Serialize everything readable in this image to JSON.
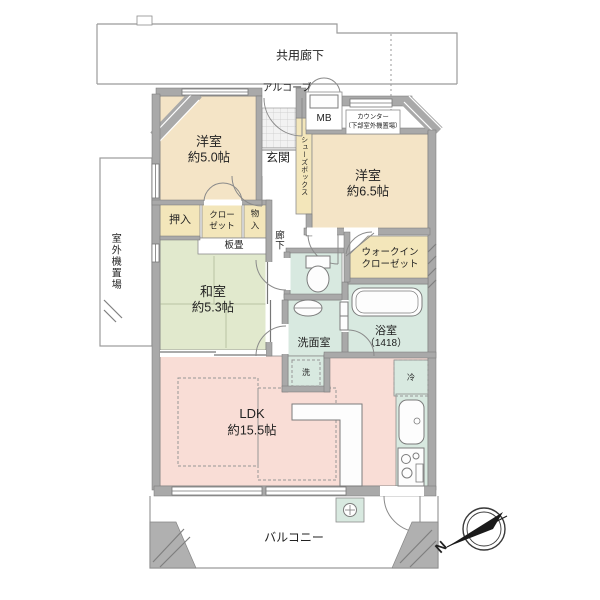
{
  "colors": {
    "wall": "#a9a9a9",
    "beige": "#f4e4c6",
    "cream": "#f3e6ba",
    "green": "#e1e9cd",
    "pink": "#f9ddd6",
    "teal": "#d8e9e0",
    "text": "#222222"
  },
  "labels": {
    "common_corridor": "共用廊下",
    "alcove": "アルコーブ",
    "meter_box": "MB",
    "counter_line1": "カウンター",
    "counter_line2": "（下部室外機置場）",
    "entrance": "玄関",
    "shoe_box": "シューズボックス",
    "western_room_1_name": "洋室",
    "western_room_1_size": "約5.0帖",
    "western_room_2_name": "洋室",
    "western_room_2_size": "約6.5帖",
    "japanese_room_name": "和室",
    "japanese_room_size": "約5.3帖",
    "oshiire": "押入",
    "closet_line1": "クロー",
    "closet_line2": "ゼット",
    "storage_line1": "物",
    "storage_line2": "入",
    "wood_board": "板畳",
    "hallway": "廊下",
    "outdoor_unit_space": "室外機置場",
    "walkin_line1": "ウォークイン",
    "walkin_line2": "クローゼット",
    "washroom": "洗面室",
    "bathroom_name": "浴室",
    "bathroom_size": "（1418）",
    "laundry": "洗",
    "fridge": "冷",
    "ldk_name": "LDK",
    "ldk_size": "約15.5帖",
    "balcony": "バルコニー",
    "compass_north": "N"
  }
}
